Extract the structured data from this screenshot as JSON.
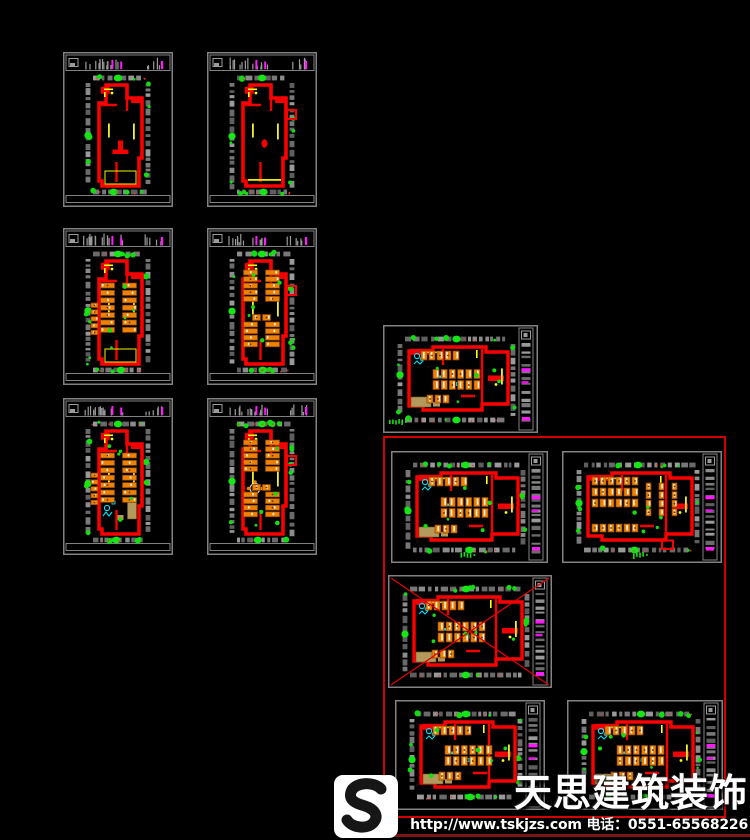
{
  "canvas": {
    "width": 750,
    "height": 840,
    "background": "#000000"
  },
  "palette": {
    "frame_gray": "#828282",
    "dim_gray": "#7a7a7a",
    "wall_red": "#fb0000",
    "marker_green": "#12dc12",
    "accent_yellow": "#f2ef34",
    "magenta": "#ff19ff",
    "cyan": "#00e4ff",
    "furniture_orange": "#ee8200",
    "tan": "#b39a5c",
    "selection_red": "#d40000",
    "watermark_white": "#ffffff",
    "watermark_underline_red": "#7a1512"
  },
  "drawings": [
    {
      "id": "p1",
      "x": 63,
      "y": 52,
      "w": 110,
      "h": 155,
      "orient": "portrait",
      "furniture": "none",
      "yellow_box": true,
      "t_shape": true,
      "seed": 11
    },
    {
      "id": "p2",
      "x": 207,
      "y": 52,
      "w": 110,
      "h": 155,
      "orient": "portrait",
      "furniture": "none",
      "blob": true,
      "yellow_line": true,
      "attach": true,
      "seed": 23
    },
    {
      "id": "p3",
      "x": 63,
      "y": 228,
      "w": 110,
      "h": 157,
      "orient": "portrait",
      "furniture": "rows",
      "yellow_box": true,
      "seed": 37
    },
    {
      "id": "p4",
      "x": 207,
      "y": 228,
      "w": 110,
      "h": 157,
      "orient": "portrait",
      "furniture": "clusters",
      "attach": true,
      "seed": 41
    },
    {
      "id": "p5",
      "x": 63,
      "y": 398,
      "w": 110,
      "h": 157,
      "orient": "portrait",
      "furniture": "rows",
      "cyan": true,
      "tan": true,
      "seed": 59
    },
    {
      "id": "p6",
      "x": 207,
      "y": 398,
      "w": 110,
      "h": 157,
      "orient": "portrait",
      "furniture": "clusters",
      "circle_table": true,
      "attach": true,
      "seed": 67
    },
    {
      "id": "l1",
      "x": 383,
      "y": 325,
      "w": 155,
      "h": 108,
      "orient": "landscape",
      "furniture": "hrows",
      "cyan": true,
      "tan": true,
      "label": "bl",
      "seed": 73
    },
    {
      "id": "l2",
      "x": 391,
      "y": 451,
      "w": 157,
      "h": 112,
      "orient": "landscape",
      "furniture": "hrows",
      "cyan": true,
      "tan": true,
      "label": "bc",
      "seed": 83
    },
    {
      "id": "l3",
      "x": 562,
      "y": 451,
      "w": 160,
      "h": 112,
      "orient": "landscape",
      "furniture": "hrows_dense",
      "label": "bc",
      "attach": true,
      "seed": 97
    },
    {
      "id": "l4",
      "x": 388,
      "y": 575,
      "w": 164,
      "h": 113,
      "orient": "landscape",
      "furniture": "hrows",
      "cyan": true,
      "tan": true,
      "crossed": true,
      "seed": 101
    },
    {
      "id": "l5",
      "x": 395,
      "y": 700,
      "w": 150,
      "h": 110,
      "orient": "landscape",
      "furniture": "hrows",
      "cyan": true,
      "tan": true,
      "seed": 113
    },
    {
      "id": "l6",
      "x": 567,
      "y": 700,
      "w": 156,
      "h": 110,
      "orient": "landscape",
      "furniture": "hrows",
      "cyan": true,
      "tan": true,
      "seed": 127
    }
  ],
  "selection_rect": {
    "x": 383,
    "y": 436,
    "w": 343,
    "h": 382
  },
  "bottom_line": {
    "x": 383,
    "y": 834,
    "w": 367,
    "h": 3
  },
  "watermark": {
    "brand": "天思建筑装饰",
    "contact": "http://www.tskjzs.com 电话：0551-65568226"
  }
}
